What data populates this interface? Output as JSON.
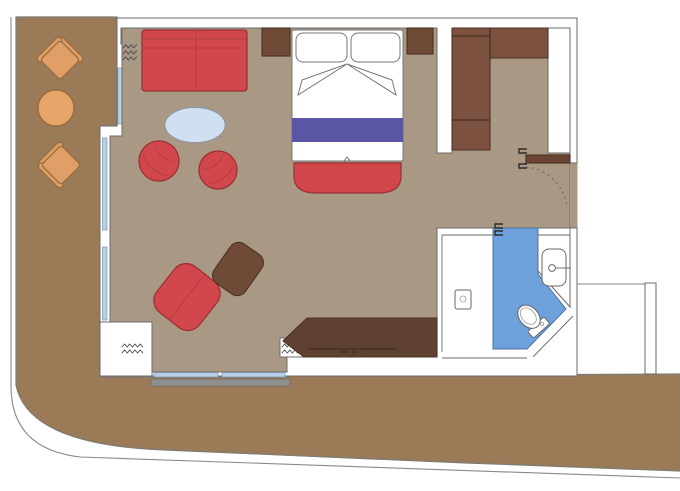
{
  "canvas": {
    "width": 680,
    "height": 491
  },
  "plan_type": "cabin-floor-plan-with-balcony",
  "colors": {
    "background": "#ffffff",
    "deck": "#9b7a58",
    "floor": "#a89884",
    "wall": "#ffffff",
    "outline": "#6b6b6b",
    "red": "#d2474b",
    "red_dark": "#9c3136",
    "wood": "#6f4a37",
    "wood_dark": "#5e4130",
    "wardrobe": "#7c5140",
    "purple": "#5a55a5",
    "table_blue": "#cfe0f2",
    "bath_blue": "#6ea0dc",
    "orange": "#df9f67",
    "orange_table": "#e8a569",
    "window": "#b8cfe8",
    "railing_gray": "#8f8f8f",
    "door_wood": "#6a4533",
    "linen_white": "#ffffff"
  },
  "elements": {
    "outdoor": [
      "deck-band",
      "balcony-chair x2",
      "balcony-round-table"
    ],
    "living": [
      "sofa",
      "oval-coffee-table",
      "tub-chair x2",
      "lounge-armchair",
      "ottoman",
      "desk-console",
      "curtains x3",
      "windows"
    ],
    "sleeping": [
      "double-bed",
      "pillows x2",
      "runner-stripe",
      "foot-bench",
      "nightstand x2"
    ],
    "storage": [
      "l-shaped-wardrobe"
    ],
    "entry": [
      "entrance-door",
      "door-swing-arc"
    ],
    "bathroom": [
      "wet-floor",
      "shower-control",
      "washbasin",
      "toilet",
      "sliding-door-handle"
    ]
  }
}
